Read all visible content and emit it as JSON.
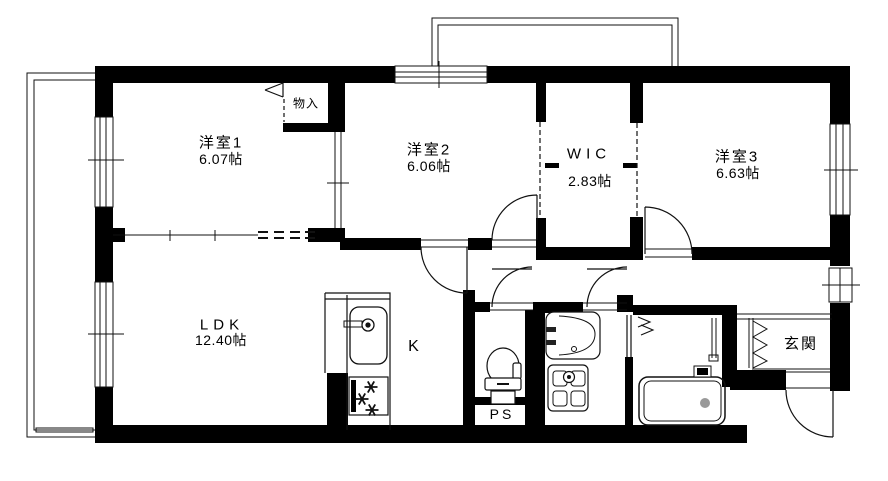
{
  "rooms": {
    "yoshitsu1": {
      "name": "洋室1",
      "size": "6.07帖"
    },
    "yoshitsu2": {
      "name": "洋室2",
      "size": "6.06帖"
    },
    "wic": {
      "name": "WIC",
      "size": "2.83帖"
    },
    "yoshitsu3": {
      "name": "洋室3",
      "size": "6.63帖"
    },
    "ldk": {
      "name": "LDK",
      "size": "12.40帖"
    },
    "kitchen": {
      "name": "K"
    },
    "closet": {
      "name": "物入"
    },
    "pipe_space": {
      "name": "PS"
    },
    "entrance": {
      "name": "玄関"
    }
  },
  "colors": {
    "wall": "#000000",
    "background": "#ffffff",
    "line": "#111111"
  }
}
